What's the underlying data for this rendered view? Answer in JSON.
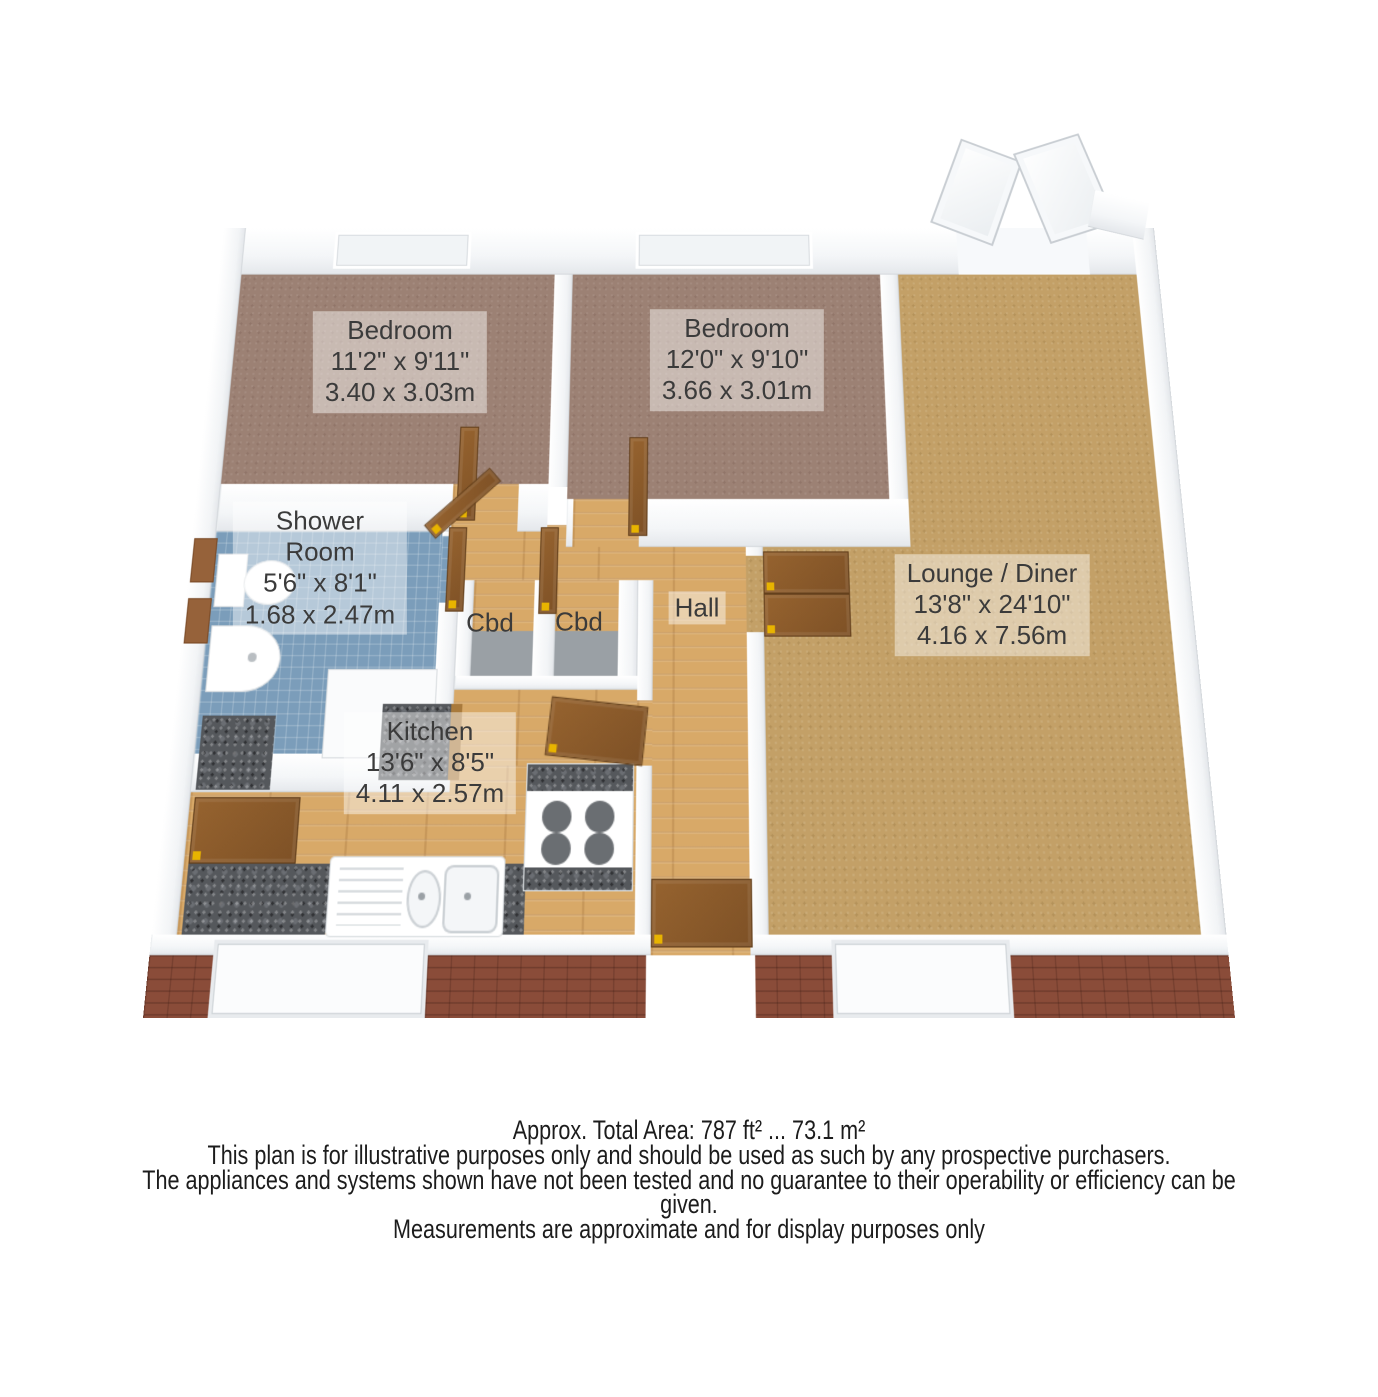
{
  "plan": {
    "type": "3d-floor-plan",
    "rooms": {
      "bedroom1": {
        "name": "Bedroom",
        "imperial": "11'2\" x 9'11\"",
        "metric": "3.40 x 3.03m",
        "floor": "mauve-carpet"
      },
      "bedroom2": {
        "name": "Bedroom",
        "imperial": "12'0\" x 9'10\"",
        "metric": "3.66 x 3.01m",
        "floor": "mauve-carpet"
      },
      "shower": {
        "name_line1": "Shower",
        "name_line2": "Room",
        "imperial": "5'6\" x 8'1\"",
        "metric": "1.68 x 2.47m",
        "floor": "blue-tile"
      },
      "lounge": {
        "name": "Lounge / Diner",
        "imperial": "13'8\" x 24'10\"",
        "metric": "4.16 x 7.56m",
        "floor": "tan-carpet"
      },
      "kitchen": {
        "name": "Kitchen",
        "imperial": "13'6\" x 8'5\"",
        "metric": "4.11 x 2.57m",
        "floor": "wood"
      },
      "hall": {
        "name": "Hall",
        "floor": "wood"
      },
      "cupboard1": {
        "name": "Cbd"
      },
      "cupboard2": {
        "name": "Cbd"
      }
    },
    "colors": {
      "wall": "#ffffff",
      "mauve_carpet": "#9c8174",
      "tan_carpet": "#c3a067",
      "wood": "#d8a968",
      "tile": "#7b9dba",
      "granite": "#55585c",
      "brick": "#8a4c39",
      "door_brown": "#8a5a30",
      "hinge_yellow": "#e8b400"
    }
  },
  "footer": {
    "area_line": "Approx. Total Area: 787 ft² ... 73.1 m²",
    "disclaimer1": "This plan is for illustrative purposes only and should be used as such by any prospective purchasers.",
    "disclaimer2": "The appliances and systems shown have not been tested and no guarantee to their operability or efficiency can be given.",
    "disclaimer3": "Measurements are approximate and for display purposes only"
  }
}
